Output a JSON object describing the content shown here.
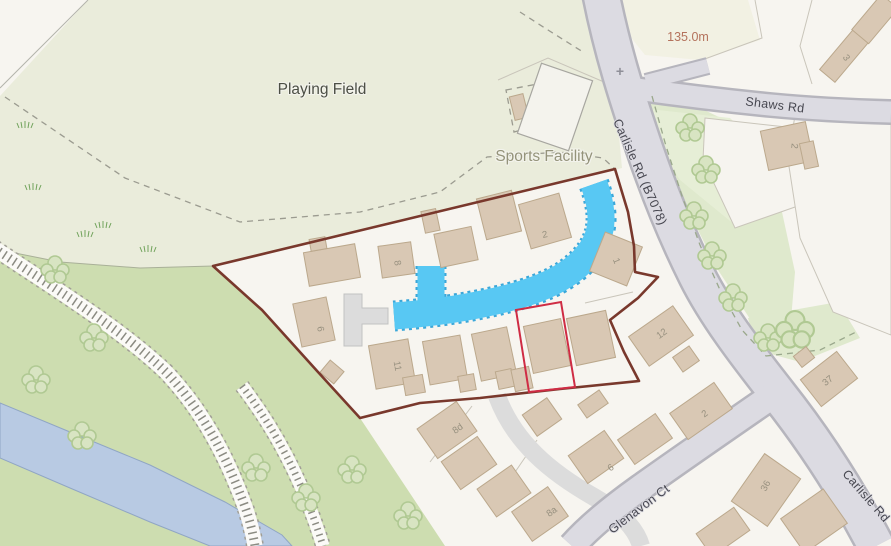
{
  "map": {
    "labels": {
      "playing_field": "Playing Field",
      "sports_facility": "Sports Facility",
      "shaws_rd": "Shaws Rd",
      "carlisle_rd_b7078": "Carlisle Rd (B7078)",
      "carlisle_rd": "Carlisle Rd",
      "glenavon_ct": "Glenavon Ct",
      "spot_elevation": "135.0m",
      "crossing_marker": "+"
    },
    "house_numbers": [
      {
        "text": "8",
        "x": 397,
        "y": 263,
        "rot": 80
      },
      {
        "text": "2",
        "x": 545,
        "y": 235,
        "rot": -12
      },
      {
        "text": "1",
        "x": 616,
        "y": 261,
        "rot": 68
      },
      {
        "text": "6",
        "x": 320,
        "y": 329,
        "rot": 80
      },
      {
        "text": "11",
        "x": 397,
        "y": 366,
        "rot": 80
      },
      {
        "text": "12",
        "x": 662,
        "y": 334,
        "rot": -35
      },
      {
        "text": "2",
        "x": 705,
        "y": 414,
        "rot": -35
      },
      {
        "text": "37",
        "x": 828,
        "y": 381,
        "rot": -38
      },
      {
        "text": "8d",
        "x": 458,
        "y": 429,
        "rot": -35
      },
      {
        "text": "8a",
        "x": 552,
        "y": 512,
        "rot": -35
      },
      {
        "text": "6",
        "x": 611,
        "y": 468,
        "rot": -35
      },
      {
        "text": "36",
        "x": 766,
        "y": 486,
        "rot": -62
      },
      {
        "text": "3",
        "x": 846,
        "y": 58,
        "rot": 55
      },
      {
        "text": "2",
        "x": 794,
        "y": 146,
        "rot": 95
      }
    ],
    "colors": {
      "site_boundary": "#79382c",
      "plot_outline": "#cf2c44",
      "stream": "#58c8f3",
      "river": "#b8cae3",
      "woodland": "#cdddb0",
      "playing_field": "#eaecdb",
      "road": "#dcdbe2",
      "building": "#d9c8b4"
    }
  }
}
